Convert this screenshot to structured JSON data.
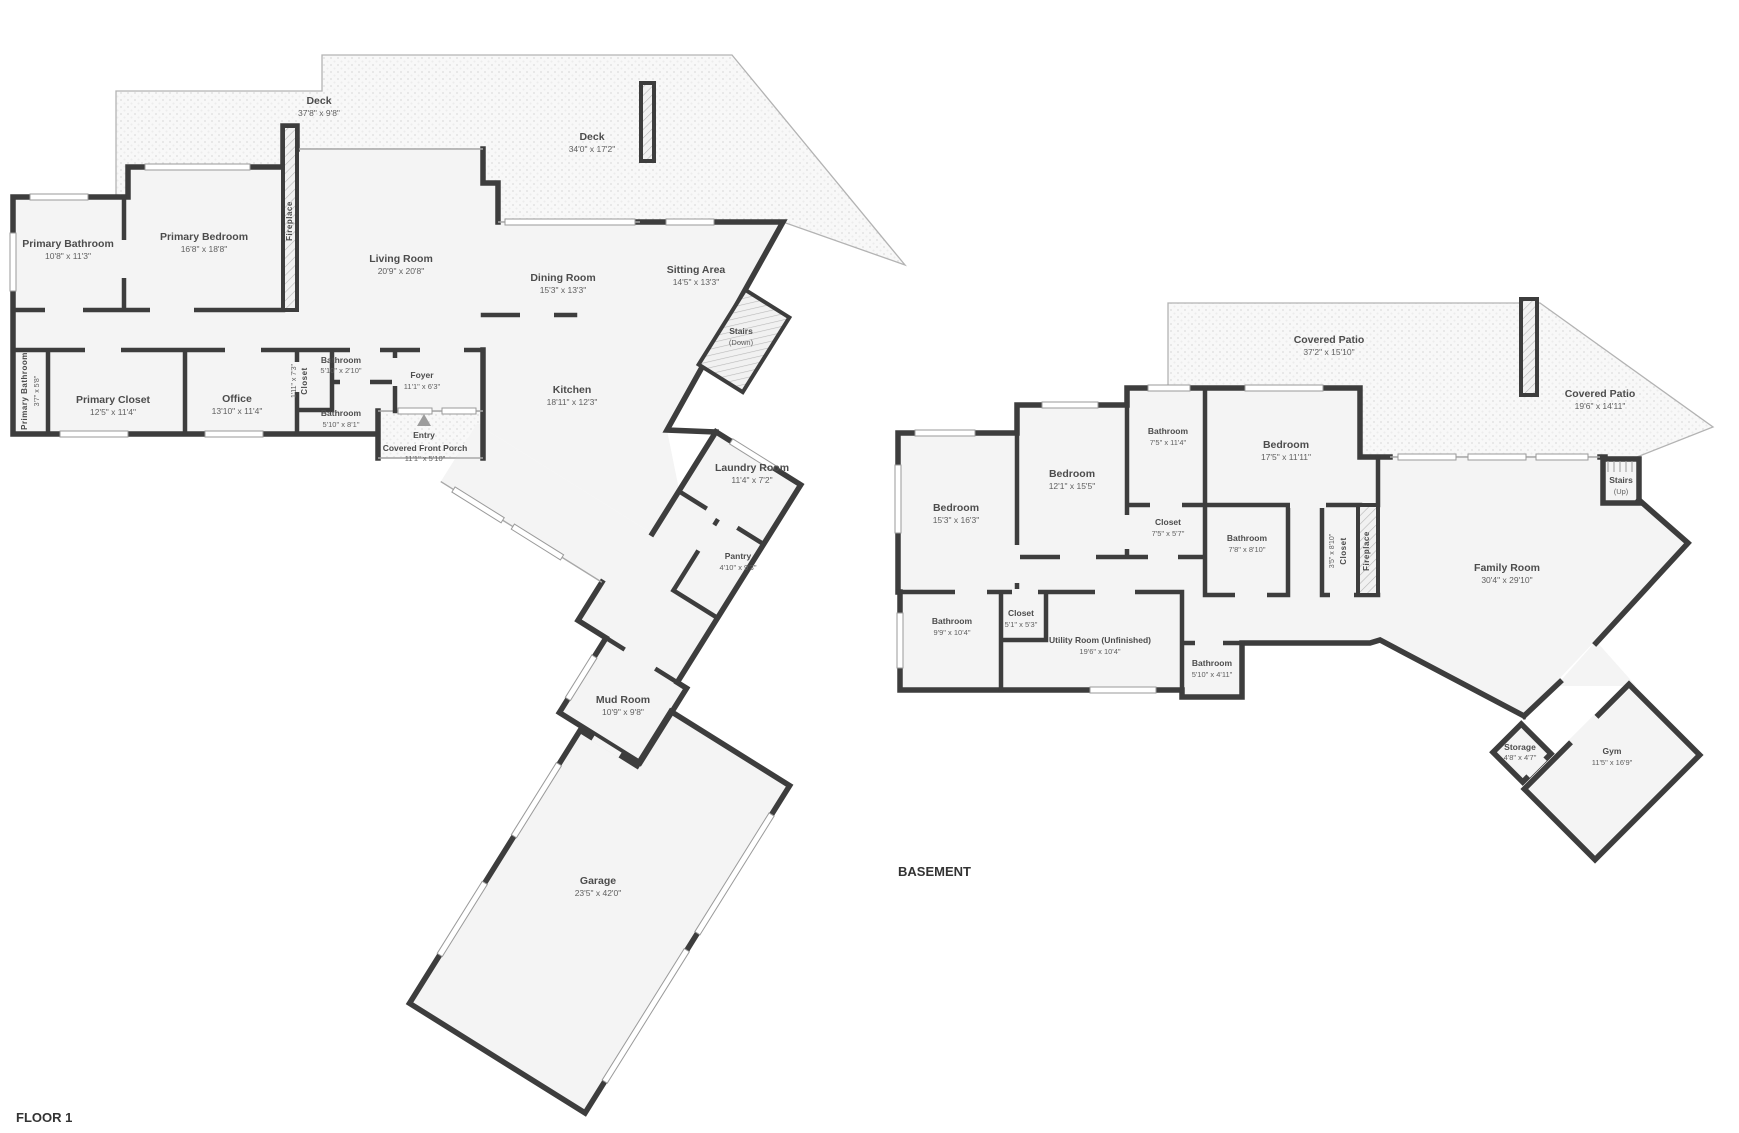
{
  "floor1": {
    "title": "FLOOR 1",
    "rooms": [
      {
        "name": "Deck",
        "size": "37'8\" x 9'8\""
      },
      {
        "name": "Deck",
        "size": "34'0\" x 17'2\""
      },
      {
        "name": "Primary Bathroom",
        "size": "10'8\" x 11'3\""
      },
      {
        "name": "Primary Bedroom",
        "size": "16'8\" x 18'8\""
      },
      {
        "name": "Fireplace",
        "size": ""
      },
      {
        "name": "Living Room",
        "size": "20'9\" x 20'8\""
      },
      {
        "name": "Dining Room",
        "size": "15'3\" x 13'3\""
      },
      {
        "name": "Sitting Area",
        "size": "14'5\" x 13'3\""
      },
      {
        "name": "Stairs",
        "size": "(Down)"
      },
      {
        "name": "Primary Bathroom",
        "size": "3'7\" x 5'8\""
      },
      {
        "name": "Primary Closet",
        "size": "12'5\" x 11'4\""
      },
      {
        "name": "Office",
        "size": "13'10\" x 11'4\""
      },
      {
        "name": "Closet",
        "size": "1'11\" x 7'3\""
      },
      {
        "name": "Bathroom",
        "size": "5'10\" x 2'10\""
      },
      {
        "name": "Bathroom",
        "size": "5'10\" x 8'1\""
      },
      {
        "name": "Foyer",
        "size": "11'1\" x 6'3\""
      },
      {
        "name": "Entry",
        "size": ""
      },
      {
        "name": "Covered Front Porch",
        "size": "11'1\" x 5'10\""
      },
      {
        "name": "Kitchen",
        "size": "18'11\" x 12'3\""
      },
      {
        "name": "Laundry Room",
        "size": "11'4\" x 7'2\""
      },
      {
        "name": "Pantry",
        "size": "4'10\" x 9'3\""
      },
      {
        "name": "Mud Room",
        "size": "10'9\" x 9'8\""
      },
      {
        "name": "Garage",
        "size": "23'5\" x 42'0\""
      }
    ]
  },
  "basement": {
    "title": "BASEMENT",
    "rooms": [
      {
        "name": "Covered Patio",
        "size": "37'2\" x 15'10\""
      },
      {
        "name": "Covered Patio",
        "size": "19'6\" x 14'11\""
      },
      {
        "name": "Stairs",
        "size": "(Up)"
      },
      {
        "name": "Bedroom",
        "size": "15'3\" x 16'3\""
      },
      {
        "name": "Bedroom",
        "size": "12'1\" x 15'5\""
      },
      {
        "name": "Bathroom",
        "size": "7'5\" x 11'4\""
      },
      {
        "name": "Bedroom",
        "size": "17'5\" x 11'11\""
      },
      {
        "name": "Closet",
        "size": "7'5\" x 5'7\""
      },
      {
        "name": "Bathroom",
        "size": "7'8\" x 8'10\""
      },
      {
        "name": "Closet",
        "size": "3'5\" x 8'10\""
      },
      {
        "name": "Fireplace",
        "size": ""
      },
      {
        "name": "Family Room",
        "size": "30'4\" x 29'10\""
      },
      {
        "name": "Bathroom",
        "size": "9'9\" x 10'4\""
      },
      {
        "name": "Closet",
        "size": "5'1\" x 5'3\""
      },
      {
        "name": "Utility Room (Unfinished)",
        "size": "19'6\" x 10'4\""
      },
      {
        "name": "Bathroom",
        "size": "5'10\" x 4'11\""
      },
      {
        "name": "Storage",
        "size": "4'8\" x 4'7\""
      },
      {
        "name": "Gym",
        "size": "11'5\" x 16'9\""
      }
    ]
  },
  "colors": {
    "wall": "#3d3d3d",
    "floor": "#f4f4f4",
    "label": "#4c4c4c"
  }
}
